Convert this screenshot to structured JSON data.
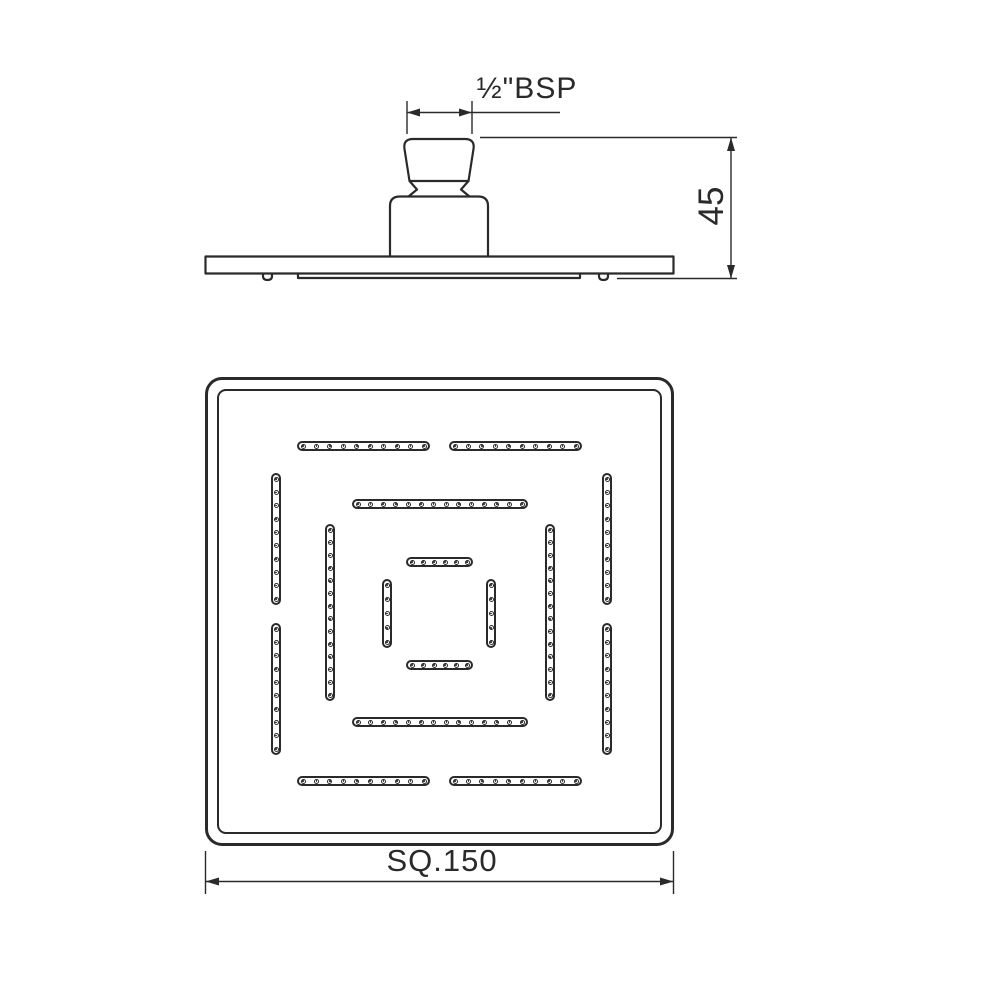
{
  "colors": {
    "line": "#2a2a2a",
    "background": "#ffffff"
  },
  "side_view": {
    "thread_label": "½\"BSP",
    "height_dimension": "45"
  },
  "face_view": {
    "width_dimension": "SQ.150",
    "pattern": {
      "strips": [
        {
          "ring": 1,
          "side": "top-left",
          "orientation": "h",
          "x": 297,
          "y": 441,
          "length": 133,
          "holes": 10
        },
        {
          "ring": 1,
          "side": "top-right",
          "orientation": "h",
          "x": 449,
          "y": 441,
          "length": 133,
          "holes": 10
        },
        {
          "ring": 1,
          "side": "bottom-left",
          "orientation": "h",
          "x": 297,
          "y": 776,
          "length": 133,
          "holes": 10
        },
        {
          "ring": 1,
          "side": "bottom-right",
          "orientation": "h",
          "x": 449,
          "y": 776,
          "length": 133,
          "holes": 10
        },
        {
          "ring": 1,
          "side": "left-top",
          "orientation": "v",
          "x": 271,
          "y": 473,
          "length": 132,
          "holes": 10
        },
        {
          "ring": 1,
          "side": "left-bottom",
          "orientation": "v",
          "x": 271,
          "y": 623,
          "length": 132,
          "holes": 10
        },
        {
          "ring": 1,
          "side": "right-top",
          "orientation": "v",
          "x": 602,
          "y": 473,
          "length": 132,
          "holes": 10
        },
        {
          "ring": 1,
          "side": "right-bottom",
          "orientation": "v",
          "x": 602,
          "y": 623,
          "length": 132,
          "holes": 10
        },
        {
          "ring": 2,
          "side": "top",
          "orientation": "h",
          "x": 352,
          "y": 499,
          "length": 176,
          "holes": 14
        },
        {
          "ring": 2,
          "side": "bottom",
          "orientation": "h",
          "x": 352,
          "y": 717,
          "length": 176,
          "holes": 14
        },
        {
          "ring": 2,
          "side": "left",
          "orientation": "v",
          "x": 325,
          "y": 524,
          "length": 177,
          "holes": 14
        },
        {
          "ring": 2,
          "side": "right",
          "orientation": "v",
          "x": 545,
          "y": 524,
          "length": 177,
          "holes": 14
        },
        {
          "ring": 3,
          "side": "top",
          "orientation": "h",
          "x": 406,
          "y": 557,
          "length": 67,
          "holes": 6
        },
        {
          "ring": 3,
          "side": "bottom",
          "orientation": "h",
          "x": 406,
          "y": 660,
          "length": 67,
          "holes": 6
        },
        {
          "ring": 3,
          "side": "left",
          "orientation": "v",
          "x": 382,
          "y": 579,
          "length": 69,
          "holes": 5
        },
        {
          "ring": 3,
          "side": "right",
          "orientation": "v",
          "x": 486,
          "y": 579,
          "length": 69,
          "holes": 5
        }
      ]
    }
  }
}
